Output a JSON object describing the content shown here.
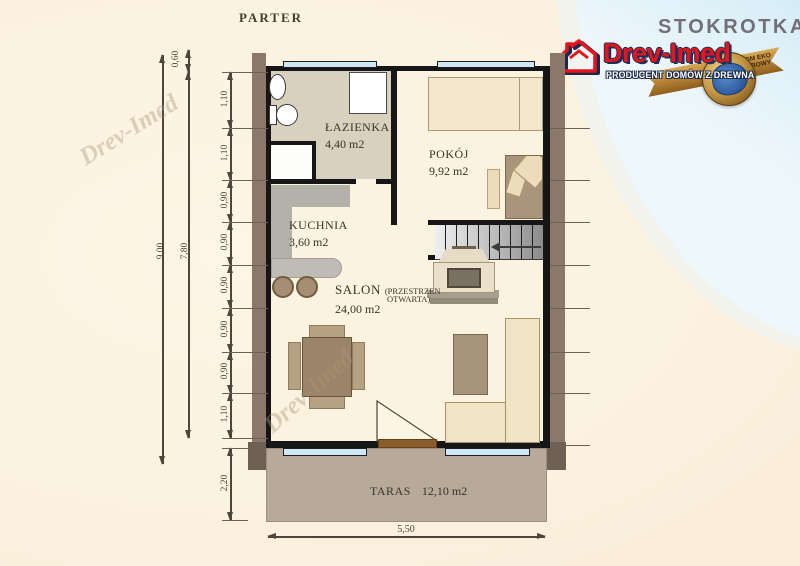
{
  "title": "PARTER",
  "branding": {
    "project": "STOKROTKA",
    "company": "Drev-Imed",
    "tagline": "PRODUCENT DOMÓW Z DREWNA",
    "badge": {
      "ribbon_line1": "DOM EKO",
      "ribbon_line2": "ZDROWY"
    },
    "watermark": "Drev-Imed",
    "colors": {
      "brand_red": "#e11a20",
      "brand_navy": "#1a2a4d",
      "sky_blue": "#3f9bc8",
      "ribbon_gold": "#b07c2a"
    }
  },
  "rooms": {
    "bathroom": {
      "name": "ŁAZIENKA",
      "area": "4,40 m2"
    },
    "bedroom": {
      "name": "POKÓJ",
      "area": "9,92 m2"
    },
    "kitchen": {
      "name": "KUCHNIA",
      "area": "3,60 m2"
    },
    "livingroom": {
      "name": "SALON",
      "note1": "(PRZESTRZEN",
      "note2": "OTWARTA)",
      "area": "24,00 m2"
    },
    "terrace": {
      "name": "TARAS",
      "area": "12,10 m2"
    }
  },
  "dimensions": {
    "total_height": "9,00",
    "wall_height": "7,80",
    "top_offset": "0,60",
    "chain": [
      "1,10",
      "1,10",
      "0,90",
      "0,90",
      "0,90",
      "0,90",
      "0,90",
      "1,10"
    ],
    "terrace_depth": "2,20",
    "bottom_width": "5,50"
  }
}
